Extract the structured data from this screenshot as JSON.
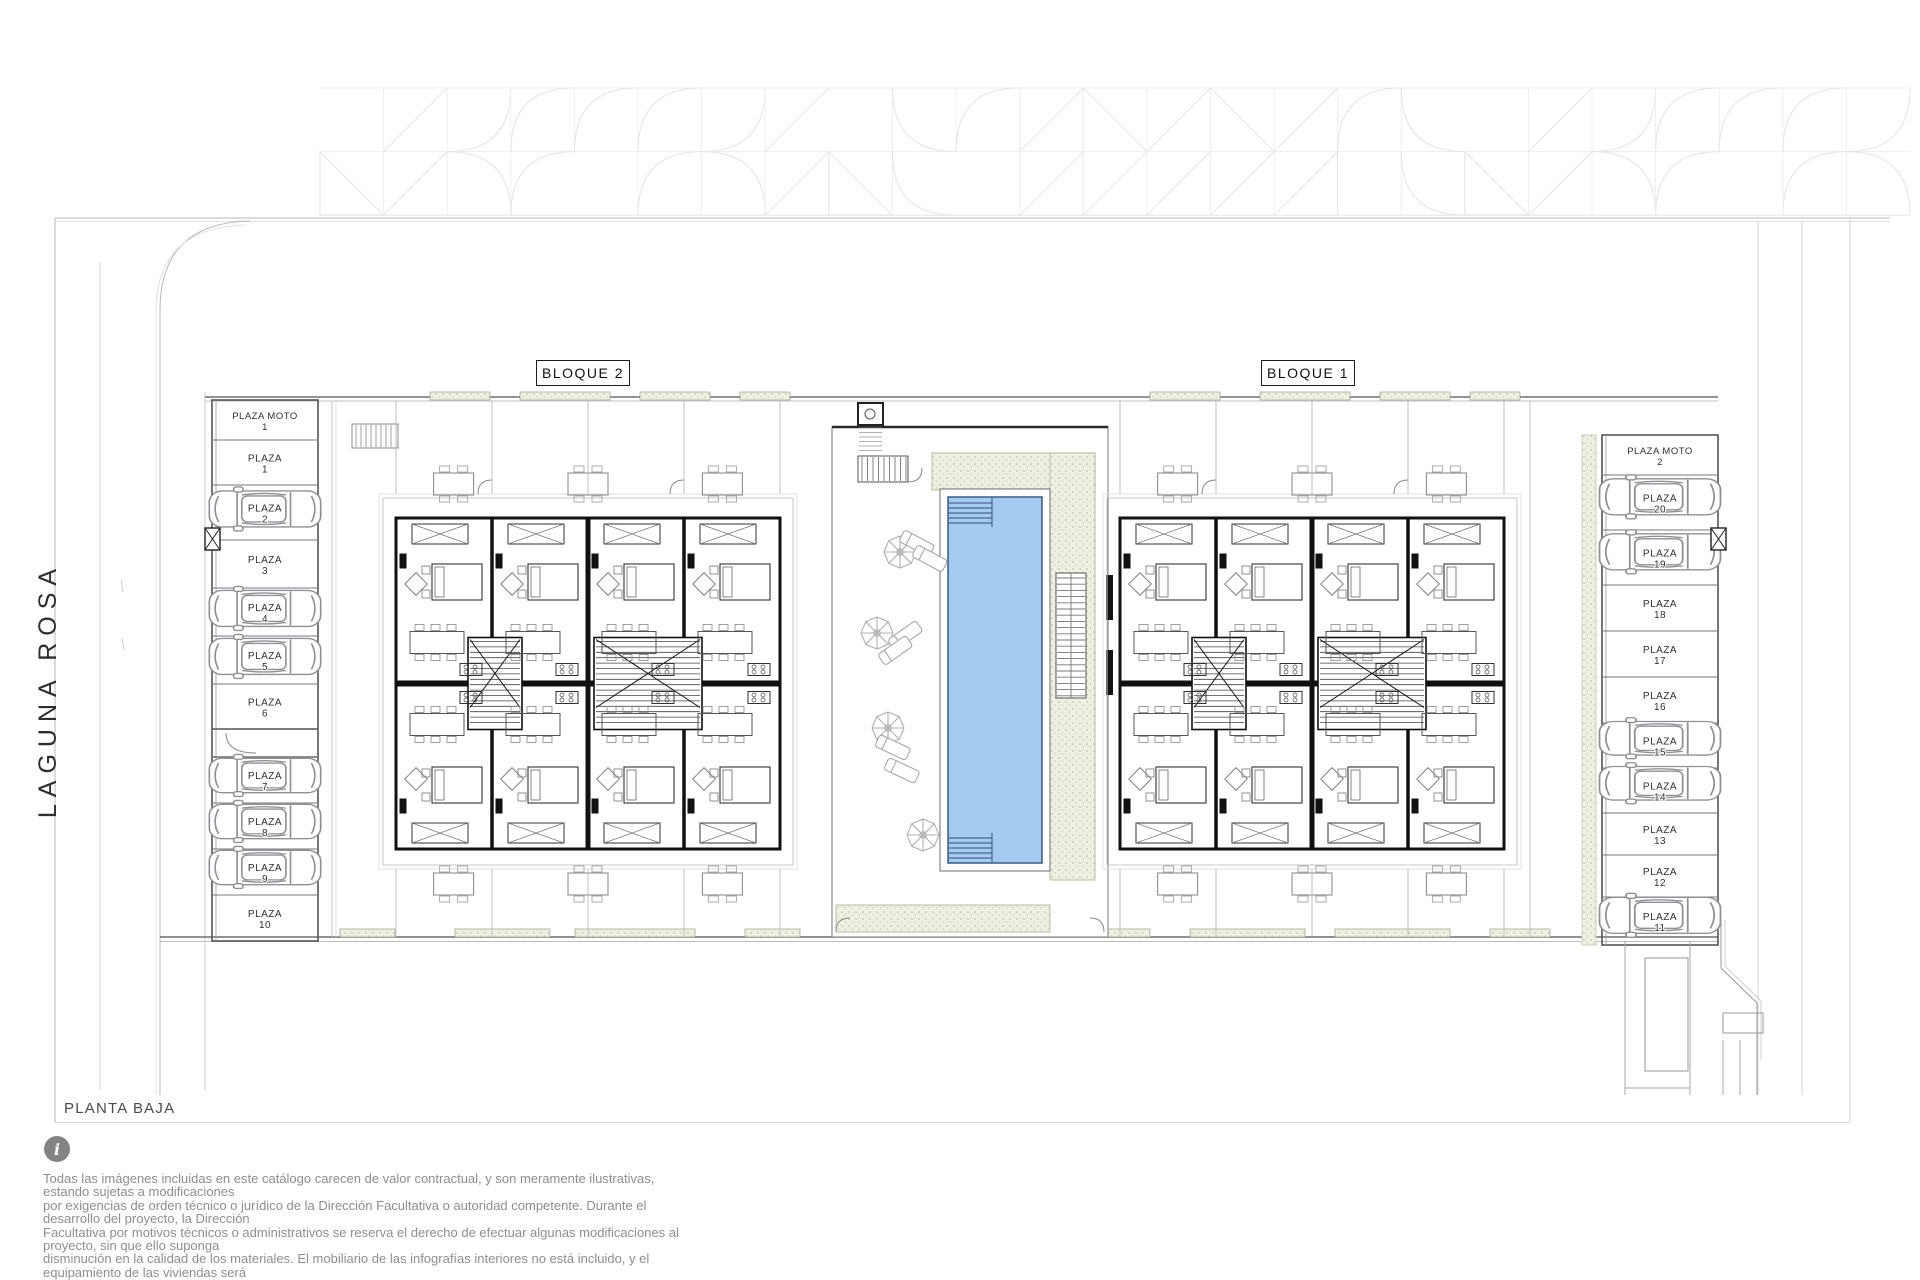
{
  "page": {
    "plan_title": "PLANTA BAJA",
    "street_name": "LAGUNA ROSA"
  },
  "blocks": [
    {
      "label": "BLOQUE 2"
    },
    {
      "label": "BLOQUE 1"
    }
  ],
  "parking_left": {
    "rows": [
      {
        "line1": "PLAZA MOTO",
        "line2": "1",
        "car": false
      },
      {
        "line1": "PLAZA",
        "line2": "1",
        "car": false
      },
      {
        "line1": "PLAZA",
        "line2": "2",
        "car": true
      },
      {
        "line1": "PLAZA",
        "line2": "3",
        "car": false
      },
      {
        "line1": "PLAZA",
        "line2": "4",
        "car": true
      },
      {
        "line1": "PLAZA",
        "line2": "5",
        "car": true
      },
      {
        "line1": "PLAZA",
        "line2": "6",
        "car": false
      },
      {
        "line1": "PLAZA",
        "line2": "7",
        "car": true
      },
      {
        "line1": "PLAZA",
        "line2": "8",
        "car": true
      },
      {
        "line1": "PLAZA",
        "line2": "9",
        "car": true
      },
      {
        "line1": "PLAZA",
        "line2": "10",
        "car": false
      }
    ]
  },
  "parking_right": {
    "rows": [
      {
        "line1": "PLAZA MOTO",
        "line2": "2",
        "car": false
      },
      {
        "line1": "PLAZA",
        "line2": "20",
        "car": true
      },
      {
        "line1": "PLAZA",
        "line2": "19",
        "car": true
      },
      {
        "line1": "PLAZA",
        "line2": "18",
        "car": false
      },
      {
        "line1": "PLAZA",
        "line2": "17",
        "car": false
      },
      {
        "line1": "PLAZA",
        "line2": "16",
        "car": false
      },
      {
        "line1": "PLAZA",
        "line2": "15",
        "car": true
      },
      {
        "line1": "PLAZA",
        "line2": "14",
        "car": true
      },
      {
        "line1": "PLAZA",
        "line2": "13",
        "car": false
      },
      {
        "line1": "PLAZA",
        "line2": "12",
        "car": false
      },
      {
        "line1": "PLAZA",
        "line2": "11",
        "car": true
      }
    ]
  },
  "disclaimer": {
    "icon": "info-icon",
    "text": "Todas las imágenes incluidas en este catálogo carecen de valor contractual, y son meramente ilustrativas, estando sujetas a modificaciones\npor exigencias de  orden técnico o jurídico de la Dirección Facultativa o autoridad competente. Durante el desarrollo del proyecto, la Dirección\nFacultativa por motivos técnicos o administrativos se reserva el derecho de efectuar algunas modificaciones al proyecto, sin que ello suponga\ndisminución  en la calidad de los materiales. El mobiliario de las infografías interiores no está incluido, y el equipamiento de las viviendas será\nel indicado en la correspondiente memoria de calidades."
  },
  "colors": {
    "pool_water": "#a6cbf1",
    "pool_edge": "#2e4f77",
    "deck": "#eef0e3",
    "deck_dot": "#bcc4a9",
    "wall": "#111111",
    "site_line": "#9a9a9a",
    "faint_line": "#e3e3e3",
    "furniture": "#8f8f8f",
    "text_gray": "#8e8e8e"
  }
}
